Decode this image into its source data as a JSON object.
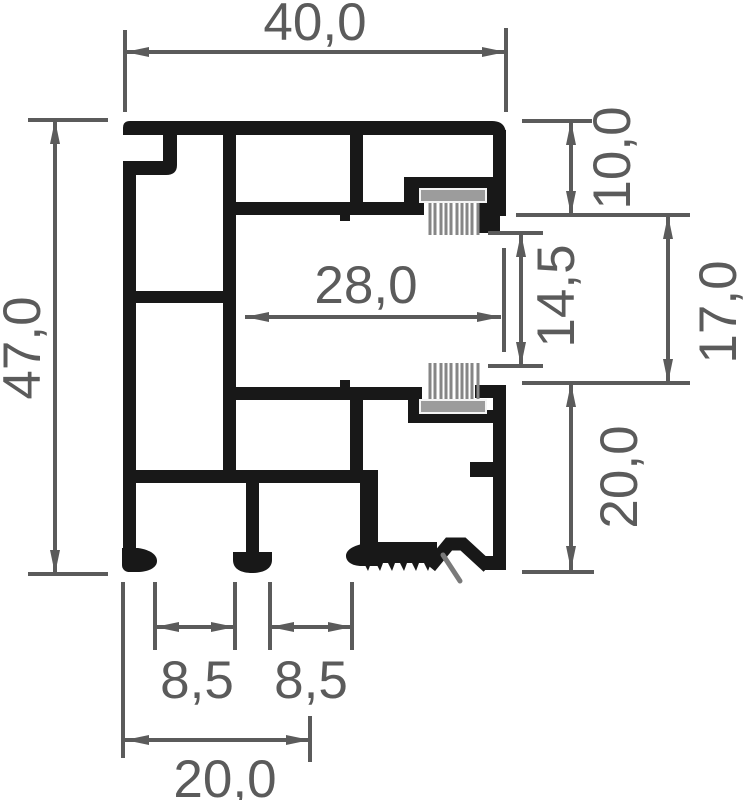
{
  "diagram": {
    "type": "technical-profile-cross-section",
    "subject": "extruded frame profile with two brush seals, dimensioned in millimetres",
    "colors": {
      "background": "#ffffff",
      "profile": "#181818",
      "dimension": "#5b5b5b",
      "brush_plate": "#9c9c9c",
      "brush_bristles": "#868686"
    },
    "dimensions": {
      "top_width": "40,0",
      "left_height": "47,0",
      "middle_depth": "28,0",
      "right_top": "10,0",
      "right_inner": "14,5",
      "right_span": "17,0",
      "right_bottom": "20,0",
      "bottom_slot_left": "8,5",
      "bottom_slot_right": "8,5",
      "bottom_width": "20,0"
    }
  }
}
